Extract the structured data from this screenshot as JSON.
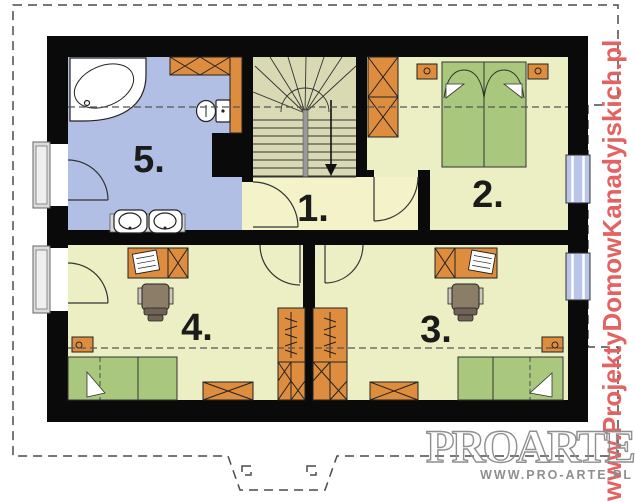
{
  "plan": {
    "room_labels": [
      {
        "id": "hallway",
        "label": "1."
      },
      {
        "id": "bedroom-right",
        "label": "2."
      },
      {
        "id": "bedroom-bottom-right",
        "label": "3."
      },
      {
        "id": "bedroom-bottom-left",
        "label": "4."
      },
      {
        "id": "bathroom",
        "label": "5."
      }
    ]
  },
  "watermarks": {
    "side_url": "www.ProjektyDomowKanadyjskich.pl",
    "logo_text": "PROARTE",
    "logo_url": "WWW.PRO-ARTE.PL"
  },
  "colors": {
    "wall": "#0a0a0a",
    "bath_floor": "#b2bfe4",
    "room_floor": "#ecefc4",
    "hall_floor": "#f3f2c8",
    "stair_floor": "#d9dab4",
    "furniture_orange": "#de8d3e",
    "bed_green": "#a9c87d",
    "roof_fill": "#f6e7e9",
    "roof_line": "#e0b9bf",
    "window_blue": "#b9c6ea",
    "window_gray": "#dcdcdc",
    "watermark_red": "#e36363",
    "logo_gray": "#8f8f8f"
  }
}
